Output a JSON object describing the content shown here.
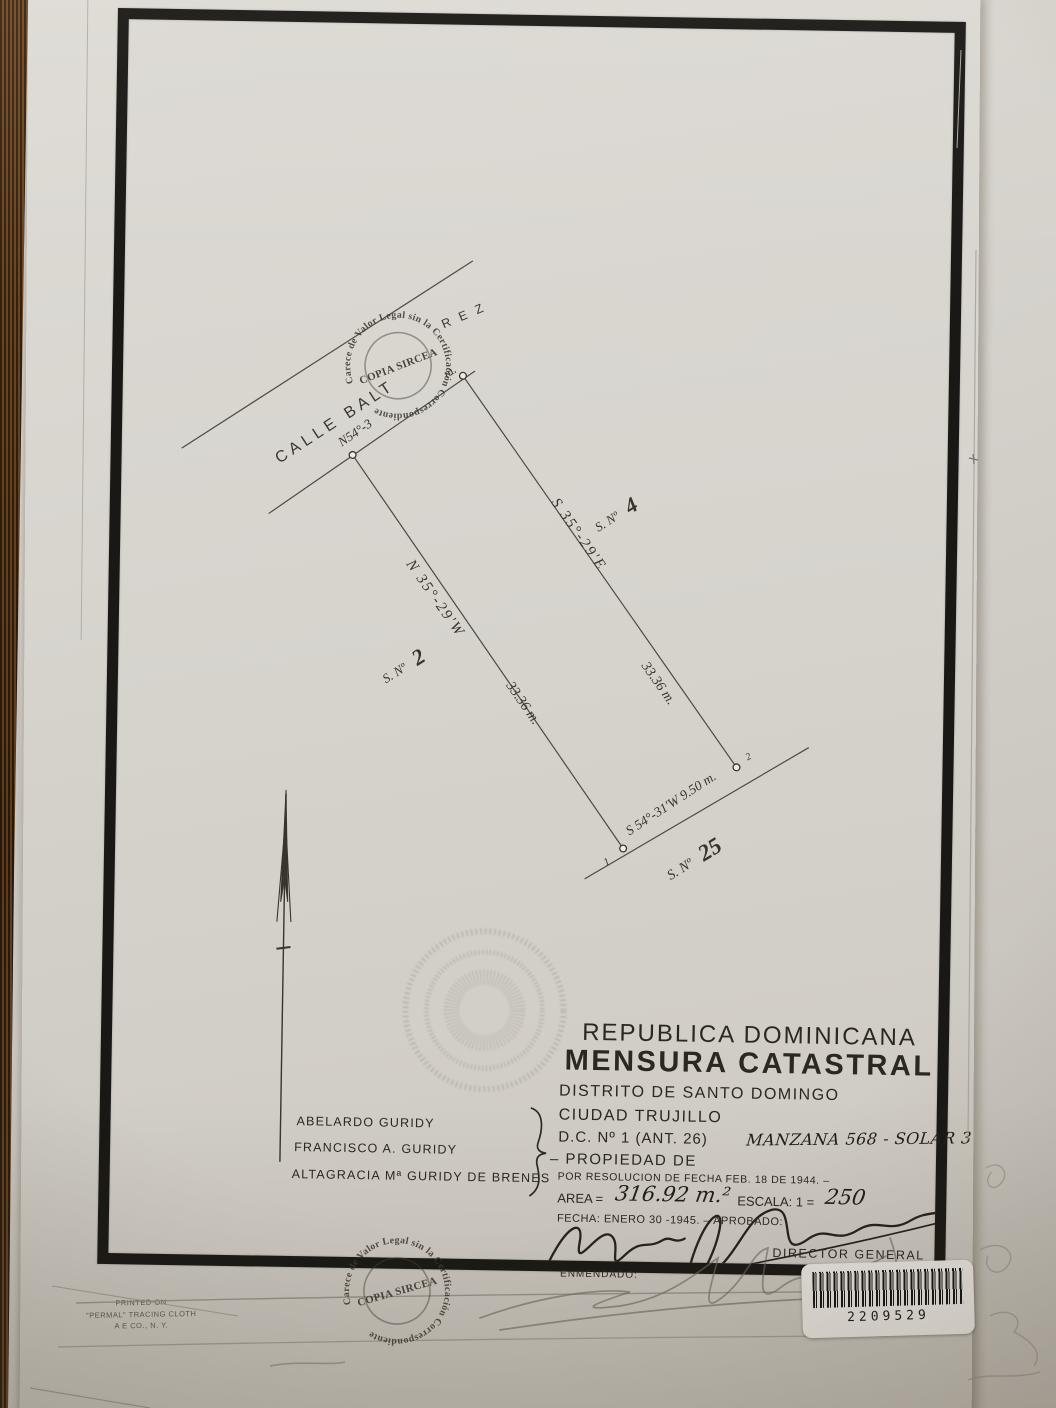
{
  "stamp": {
    "arc": "Carece de Valor Legal sin la Certificación Correspondiente",
    "center": "COPIA SIRCEA"
  },
  "plot": {
    "street_label": "CALLE BALT",
    "street_label_end": "R E Z",
    "frontage_bearing_start": "N54°-3",
    "frontage_bearing_end": "m.",
    "side_right": {
      "bearing": "S 35°-29'E",
      "length": "33.36 m.",
      "lot_prefix": "S. Nº",
      "lot_number": "4"
    },
    "side_left": {
      "bearing": "N 35°-29'W",
      "length": "33.36 m.",
      "lot_prefix": "S. Nº",
      "lot_number": "2"
    },
    "side_bottom": {
      "bearing": "S 54°-31'W  9.50 m.",
      "lot_prefix": "S. Nº",
      "lot_number": "25"
    },
    "corner_markers": {
      "c1": "1",
      "c2": "2"
    }
  },
  "title_block": {
    "country": "REPUBLICA DOMINICANA",
    "heading": "MENSURA CATASTRAL",
    "district": "DISTRITO DE SANTO DOMINGO",
    "city": "CIUDAD TRUJILLO",
    "dc_line": "D.C. Nº 1 (ANT. 26)",
    "manzana": "MANZANA 568 - SOLAR 3",
    "property_label": "– PROPIEDAD DE",
    "resolution": "POR RESOLUCION DE FECHA FEB. 18 DE 1944. –",
    "area_label": "AREA =",
    "area_value": "316.92 m.²",
    "scale_label": "ESCALA: 1 =",
    "scale_value": "250",
    "fecha_line": "FECHA: ENERO 30 -1945. –   APROBADO:",
    "director": "DIRECTOR GENERAL",
    "enmendado": "ENMENDADO:"
  },
  "owners": [
    "ABELARDO GURIDY",
    "FRANCISCO A. GURIDY",
    "ALTAGRACIA Mª GURIDY DE BRENES"
  ],
  "barcode_number": "2209529",
  "printer_note": {
    "l1": "PRINTED ON",
    "l2": "\"PERMAL\" TRACING CLOTH",
    "l3": "A E CO., N. Y."
  },
  "colors": {
    "paper": "#d8d5cf",
    "ink": "#2b2721",
    "frame": "#1b1916",
    "table": "#3c2513"
  }
}
